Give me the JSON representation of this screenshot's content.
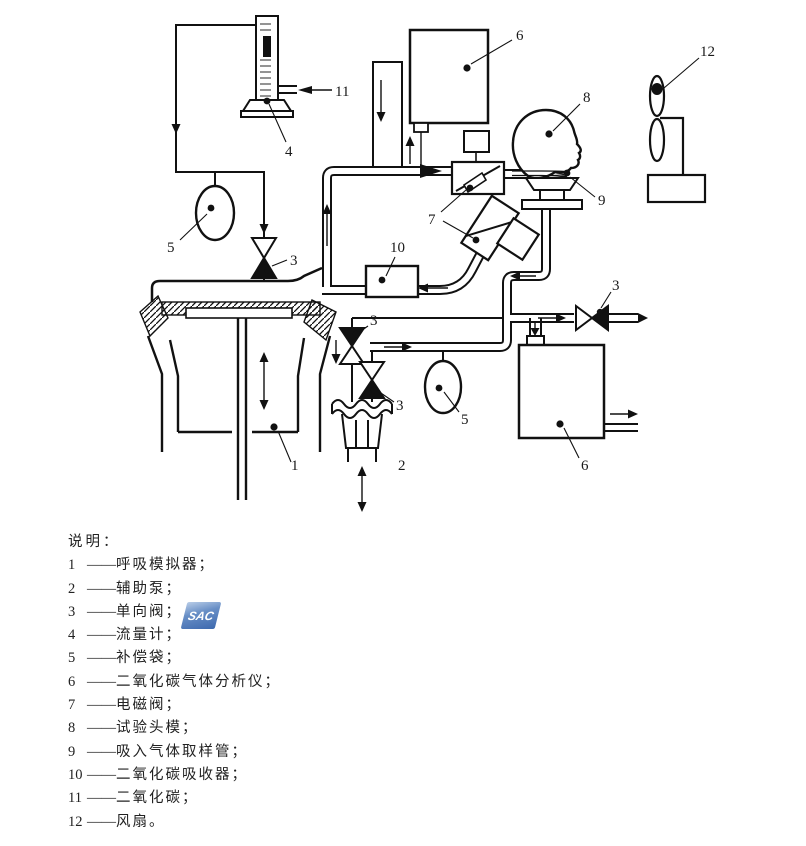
{
  "figure": {
    "callouts": {
      "n1": "1",
      "n2": "2",
      "n3": "3",
      "n4": "4",
      "n5": "5",
      "n6": "6",
      "n7": "7",
      "n8": "8",
      "n9": "9",
      "n10": "10",
      "n11": "11",
      "n12": "12"
    },
    "legend": {
      "title": "说明：",
      "dash": "——",
      "items": [
        {
          "num": "1",
          "label": "呼吸模拟器；"
        },
        {
          "num": "2",
          "label": "辅助泵；"
        },
        {
          "num": "3",
          "label": "单向阀；"
        },
        {
          "num": "4",
          "label": "流量计；"
        },
        {
          "num": "5",
          "label": "补偿袋；"
        },
        {
          "num": "6",
          "label": "二氧化碳气体分析仪；"
        },
        {
          "num": "7",
          "label": "电磁阀；"
        },
        {
          "num": "8",
          "label": "试验头模；"
        },
        {
          "num": "9",
          "label": "吸入气体取样管；"
        },
        {
          "num": "10",
          "label": "二氧化碳吸收器；"
        },
        {
          "num": "11",
          "label": "二氧化碳；"
        },
        {
          "num": "12",
          "label": "风扇。"
        }
      ]
    },
    "watermark": {
      "text": "SAC",
      "color": "#2d5da8"
    },
    "line_color": "#111111"
  }
}
